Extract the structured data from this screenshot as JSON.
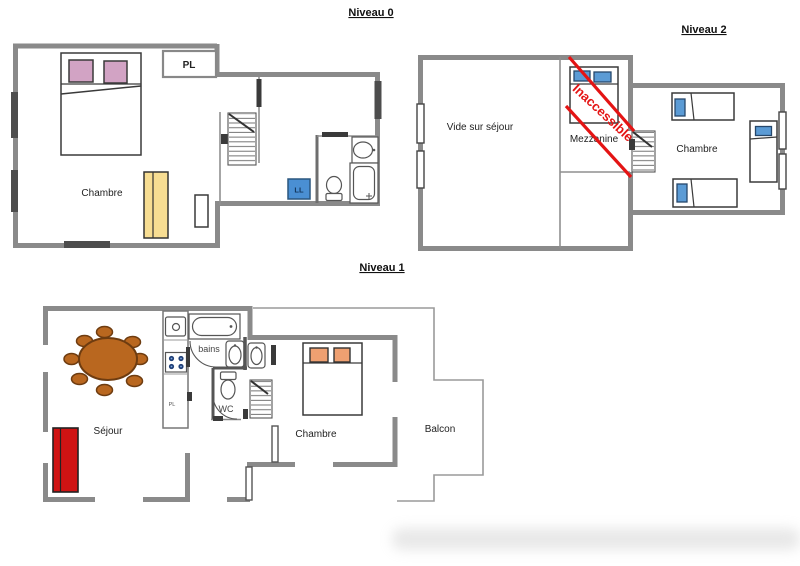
{
  "levels": {
    "n0": {
      "title": "Niveau 0",
      "rooms": {
        "chambre": "Chambre",
        "pl": "PL",
        "ll": "LL"
      }
    },
    "n2": {
      "title": "Niveau 2",
      "rooms": {
        "vide": "Vide sur séjour",
        "mezzanine": "Mezzanine",
        "chambre": "Chambre"
      },
      "annotation": "Inaccessible"
    },
    "n1": {
      "title": "Niveau 1",
      "rooms": {
        "sejour": "Séjour",
        "bains": "bains",
        "wc": "WC",
        "pl": "PL",
        "chambre": "Chambre",
        "balcon": "Balcon"
      }
    }
  },
  "colors": {
    "wall": "#8a8a8a",
    "window_dark": "#4d4d4d",
    "door_dark": "#3a3a3a",
    "pillow_pink": "#d2a3c4",
    "pillow_blue": "#5b9bd5",
    "pillow_orange": "#efa071",
    "wardrobe_yellow": "#f7dd92",
    "washer_blue": "#4a8fd3",
    "sofa_red": "#cf1313",
    "table_brown": "#b9671f",
    "table_brown_dark": "#6e3c10",
    "inaccessible_red": "#e41414",
    "burner_blue": "#1f3f77"
  }
}
